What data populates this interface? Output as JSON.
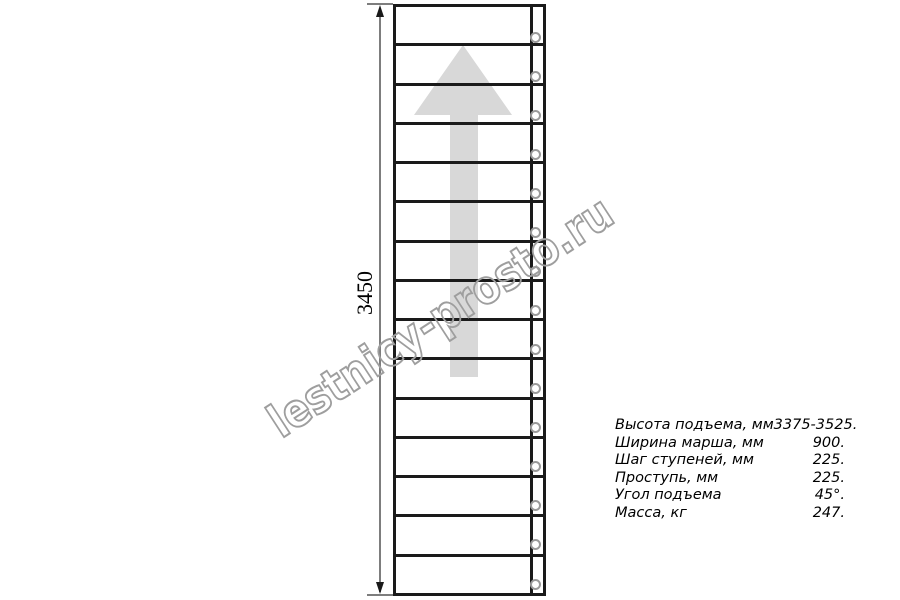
{
  "drawing": {
    "steps_count": 15,
    "dimension_label": "3450",
    "direction_arrow": "up",
    "colors": {
      "outline": "#1a1a1a",
      "arrow_fill": "#d8d8d8",
      "dimension_line": "#7d7d7d",
      "fastener_ring": "#9a9a9a"
    }
  },
  "specs": {
    "rows": [
      {
        "label": "Высота подъема, мм",
        "value": "3375-3525."
      },
      {
        "label": "Ширина марша, мм",
        "value": "900."
      },
      {
        "label": "Шаг ступеней, мм",
        "value": "225."
      },
      {
        "label": "Проступь, мм",
        "value": "225."
      },
      {
        "label": "Угол подъема",
        "value": "45°."
      },
      {
        "label": "Масса, кг",
        "value": "247."
      }
    ]
  },
  "watermark": {
    "text": "lestnicy-prosto.ru",
    "color": "#9e9e9e"
  }
}
